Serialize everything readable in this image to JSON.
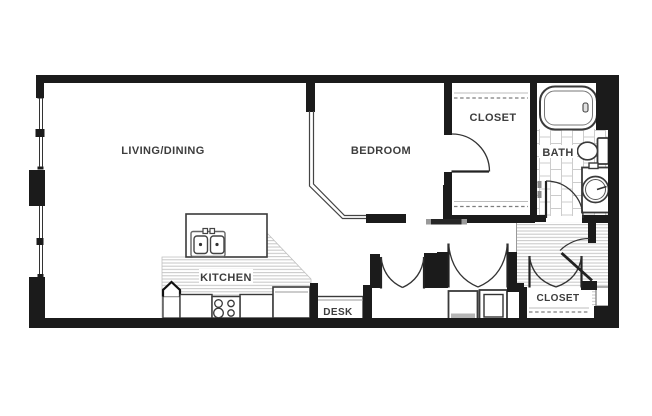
{
  "plan": {
    "rooms": [
      {
        "name": "living-dining",
        "label": "LIVING/DINING"
      },
      {
        "name": "bedroom",
        "label": "BEDROOM"
      },
      {
        "name": "closet-top",
        "label": "CLOSET"
      },
      {
        "name": "bath",
        "label": "BATH"
      },
      {
        "name": "kitchen",
        "label": "KITCHEN"
      },
      {
        "name": "desk",
        "label": "DESK"
      },
      {
        "name": "closet-bottom",
        "label": "CLOSET"
      }
    ],
    "colors": {
      "background": "#ffffff",
      "wall": "#1b1b1b",
      "label_text": "#3d3d3d",
      "floor_stripe": "#c6c6c6",
      "tile_line": "#cccccc"
    }
  }
}
